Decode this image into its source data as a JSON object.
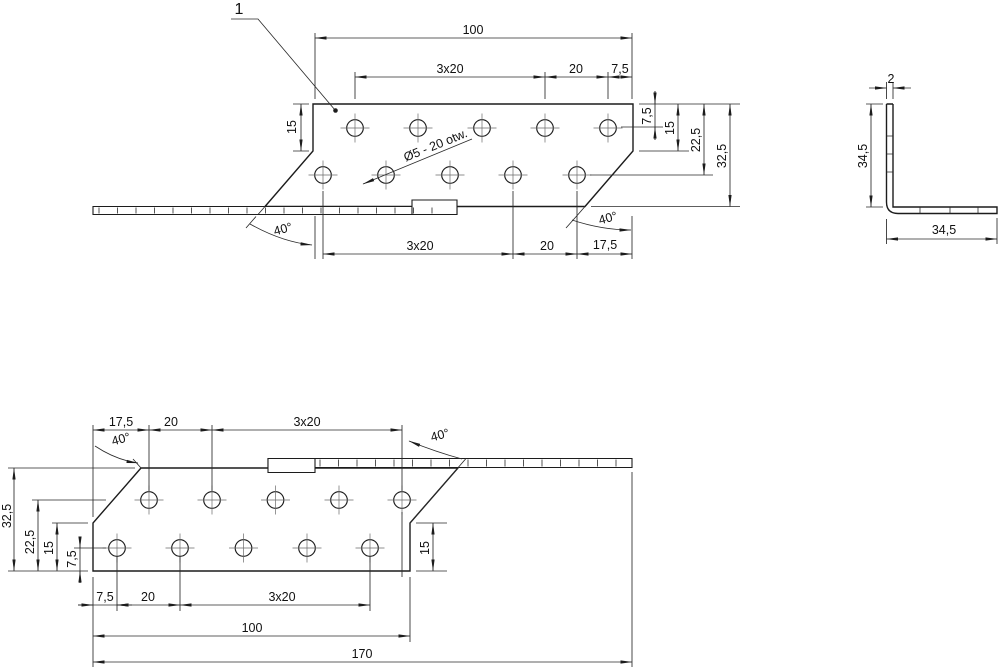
{
  "drawing": {
    "callout_1": "1",
    "hole_note": "Ø5 - 20 otw.",
    "top_view": {
      "dim_width_total": "100",
      "dim_pitch_top": "3x20",
      "dim_20_top": "20",
      "dim_7_5_top": "7,5",
      "dim_15_left": "15",
      "dim_7_5_right": "7,5",
      "dim_15_right": "15",
      "dim_22_5_right": "22,5",
      "dim_32_5_right": "32,5",
      "angle_left": "40°",
      "angle_right": "40°",
      "dim_pitch_bottom": "3x20",
      "dim_20_bottom": "20",
      "dim_17_5_bottom": "17,5"
    },
    "side_view": {
      "dim_thickness": "2",
      "dim_height": "34,5",
      "dim_width": "34,5"
    },
    "bottom_view": {
      "dim_17_5_top": "17,5",
      "dim_20_top": "20",
      "dim_pitch_top": "3x20",
      "angle_left": "40°",
      "angle_right": "40°",
      "dim_32_5_left": "32,5",
      "dim_22_5_left": "22,5",
      "dim_15_left": "15",
      "dim_7_5_left": "7,5",
      "dim_15_right": "15",
      "dim_7_5_bottom": "7,5",
      "dim_20_bottom": "20",
      "dim_pitch_bottom": "3x20",
      "dim_width_plate": "100",
      "dim_length_total": "170"
    }
  }
}
